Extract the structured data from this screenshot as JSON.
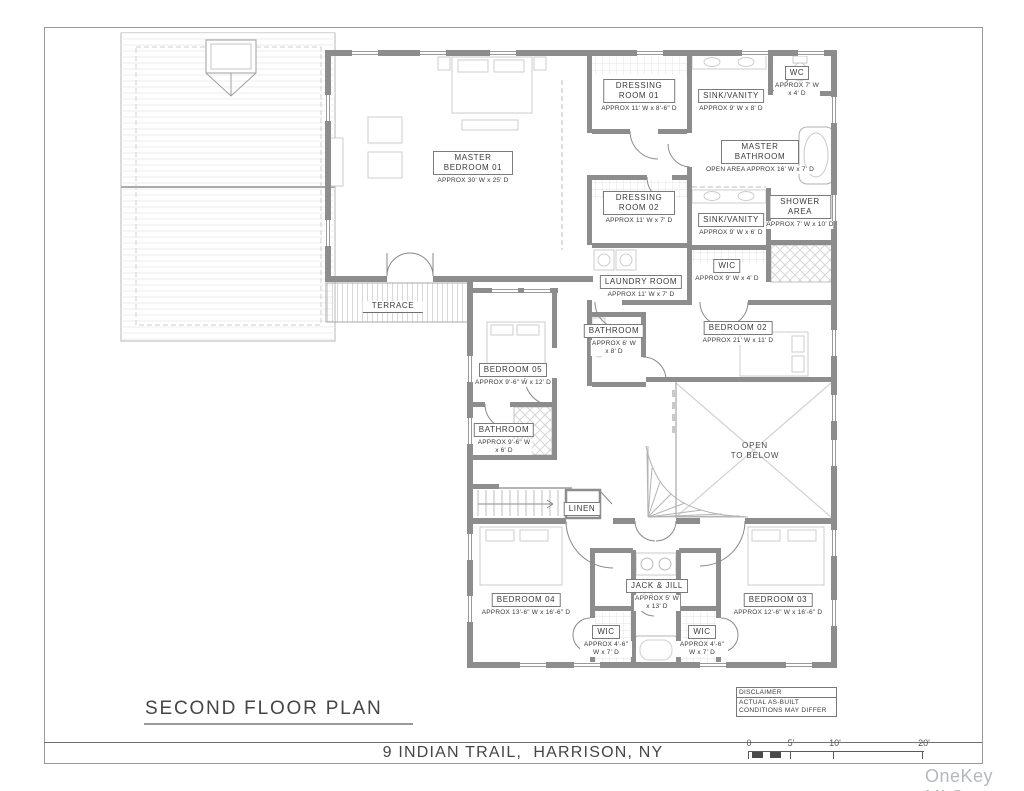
{
  "page": {
    "sheet_title": "SECOND FLOOR PLAN",
    "address": "9 INDIAN TRAIL,  HARRISON, NY",
    "watermark": "OneKey MLS"
  },
  "disclaimer": {
    "title": "DISCLAIMER",
    "body": "ACTUAL AS-BUILT CONDITIONS MAY DIFFER"
  },
  "scale_bar": {
    "ticks": [
      "0",
      "5'",
      "10'",
      "20'"
    ]
  },
  "rooms": {
    "master_bedroom": {
      "name": "MASTER BEDROOM 01",
      "dims": "APPROX 30' W x 25' D"
    },
    "dressing_room_01": {
      "name": "DRESSING ROOM 01",
      "dims": "APPROX 11' W x 8'-6\" D"
    },
    "sink_vanity_1": {
      "name": "SINK/VANITY",
      "dims": "APPROX 9' W x 8' D"
    },
    "wc": {
      "name": "WC",
      "dims": "APPROX 7' W x 4' D"
    },
    "master_bathroom": {
      "name": "MASTER BATHROOM",
      "dims": "OPEN AREA APPROX 16' W x 7' D"
    },
    "dressing_room_02": {
      "name": "DRESSING ROOM 02",
      "dims": "APPROX 11' W x 7' D"
    },
    "sink_vanity_2": {
      "name": "SINK/VANITY",
      "dims": "APPROX 9' W x 6' D"
    },
    "shower_area": {
      "name": "SHOWER AREA",
      "dims": "APPROX 7' W x 10' D"
    },
    "wic_master": {
      "name": "WIC",
      "dims": "APPROX 9' W x 4' D"
    },
    "laundry_room": {
      "name": "LAUNDRY ROOM",
      "dims": "APPROX 11' W x 7' D"
    },
    "bathroom_hall": {
      "name": "BATHROOM",
      "dims": "APPROX 6' W x 8' D"
    },
    "bedroom_02": {
      "name": "BEDROOM 02",
      "dims": "APPROX 21' W x 11' D"
    },
    "terrace": {
      "name": "TERRACE"
    },
    "bedroom_05": {
      "name": "BEDROOM 05",
      "dims": "APPROX 9'-6\" W x 12' D"
    },
    "bathroom_05": {
      "name": "BATHROOM",
      "dims": "APPROX 9'-6\" W x 6' D"
    },
    "open_to_below": {
      "name": "OPEN\nTO BELOW"
    },
    "linen": {
      "name": "LINEN"
    },
    "bedroom_04": {
      "name": "BEDROOM 04",
      "dims": "APPROX 13'-6\" W x 16'-6\" D"
    },
    "jack_and_jill": {
      "name": "JACK & JILL",
      "dims": "APPROX 5' W x 13' D"
    },
    "wic_bedroom_04": {
      "name": "WIC",
      "dims": "APPROX 4'-6\" W x 7' D"
    },
    "wic_bedroom_03": {
      "name": "WIC",
      "dims": "APPROX 4'-6\" W x 7' D"
    },
    "bedroom_03": {
      "name": "BEDROOM 03",
      "dims": "APPROX 12'-6\" W x 16'-6\" D"
    }
  }
}
